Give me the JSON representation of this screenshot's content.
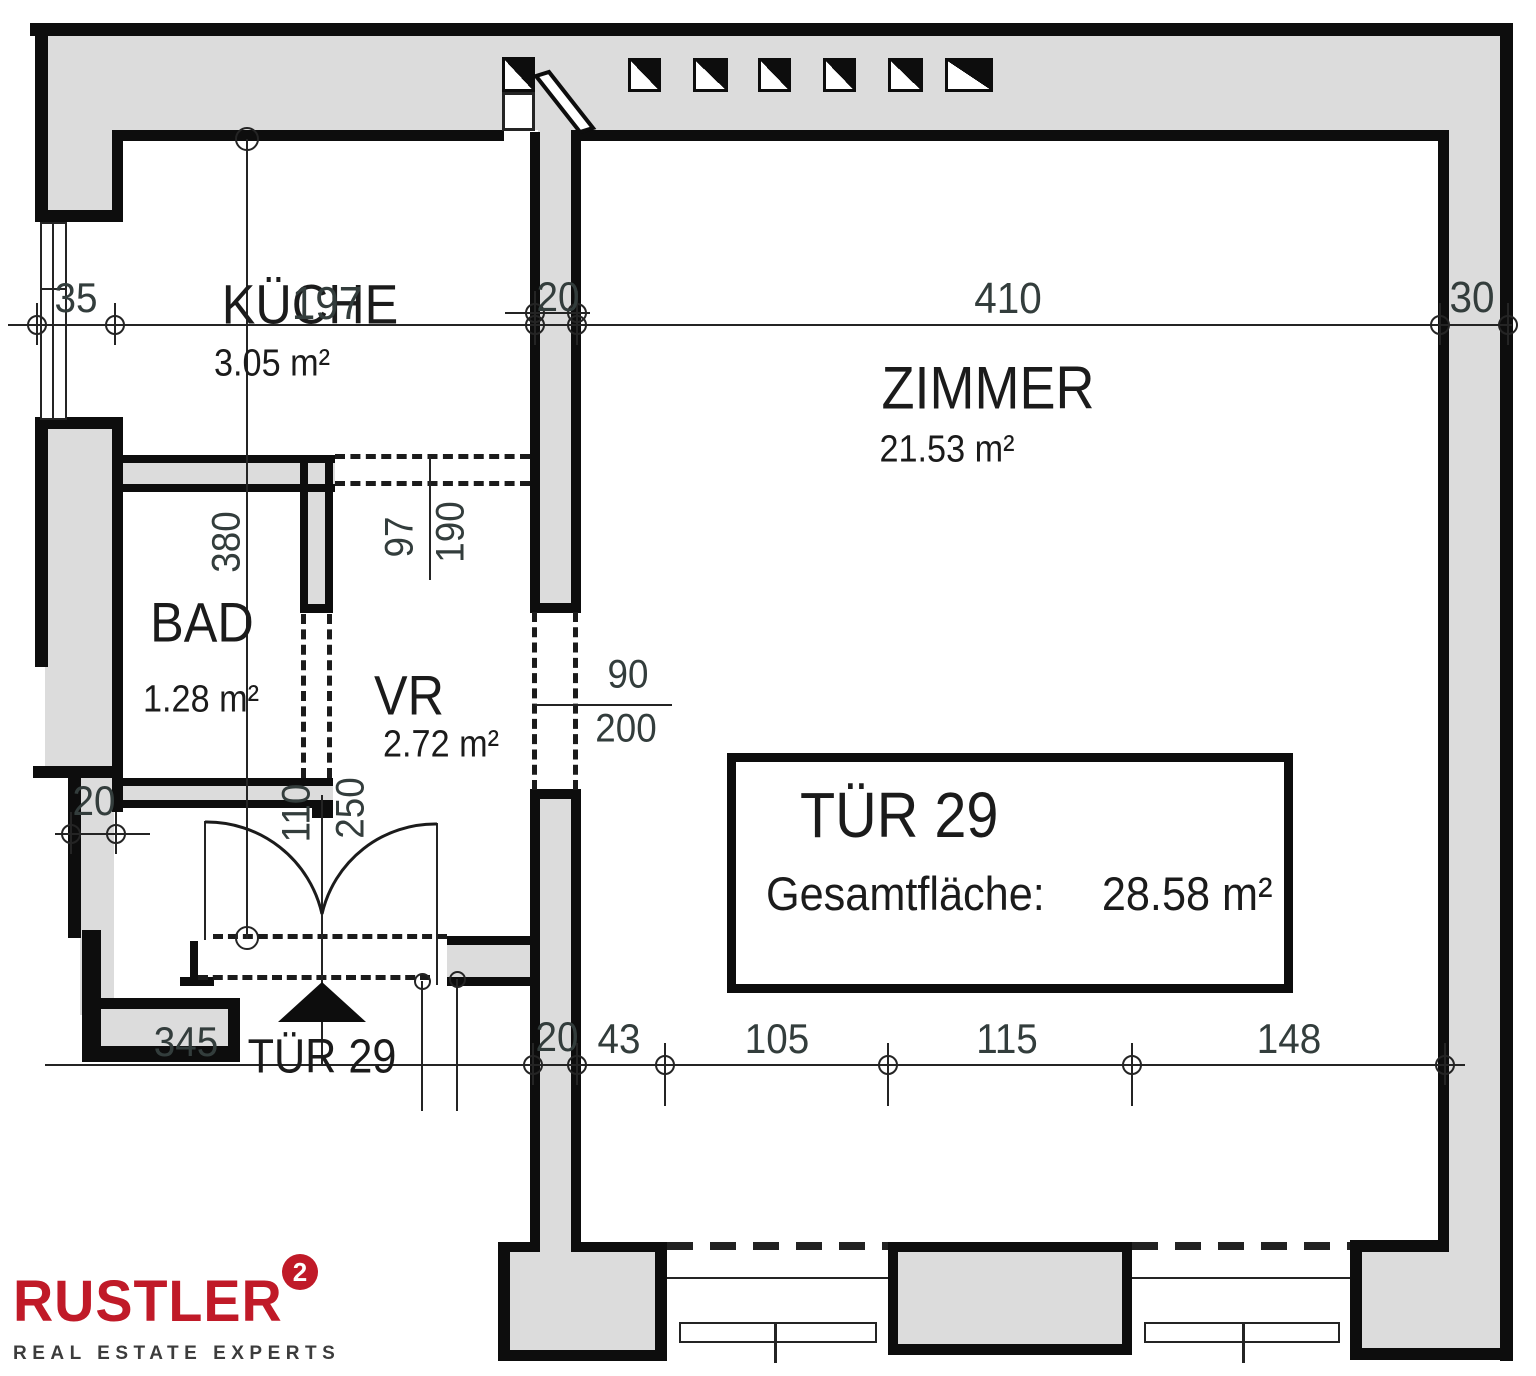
{
  "plan": {
    "rooms": {
      "kueche": {
        "name": "KÜCHE",
        "area": "3.05 m²"
      },
      "zimmer": {
        "name": "ZIMMER",
        "area": "21.53 m²"
      },
      "bad": {
        "name": "BAD",
        "area": "1.28 m²"
      },
      "vr": {
        "name": "VR",
        "area": "2.72 m²"
      }
    },
    "entrance_label": "TÜR 29",
    "info_box": {
      "title": "TÜR 29",
      "label": "Gesamtfläche:",
      "value": "28.58 m²"
    },
    "dims": {
      "d35": "35",
      "d197": "197",
      "d20_top": "20",
      "d410": "410",
      "d30": "30",
      "d380": "380",
      "d97": "97",
      "d190": "190",
      "d90": "90",
      "d200": "200",
      "d110": "110",
      "d250": "250",
      "d20_left": "20",
      "d345": "345",
      "d20_bottom": "20",
      "d43": "43",
      "d105": "105",
      "d115": "115",
      "d148": "148"
    }
  },
  "logo": {
    "brand": "RUSTLER",
    "sup": "2",
    "tagline": "REAL ESTATE EXPERTS"
  },
  "colors": {
    "wall_fill": "#dcdcdc",
    "line": "#0d0d0d",
    "dim_text": "#333d3c",
    "room_text": "#1b1b1b",
    "brand_red": "#c01a28",
    "tagline_gray": "#3c3c3c"
  }
}
